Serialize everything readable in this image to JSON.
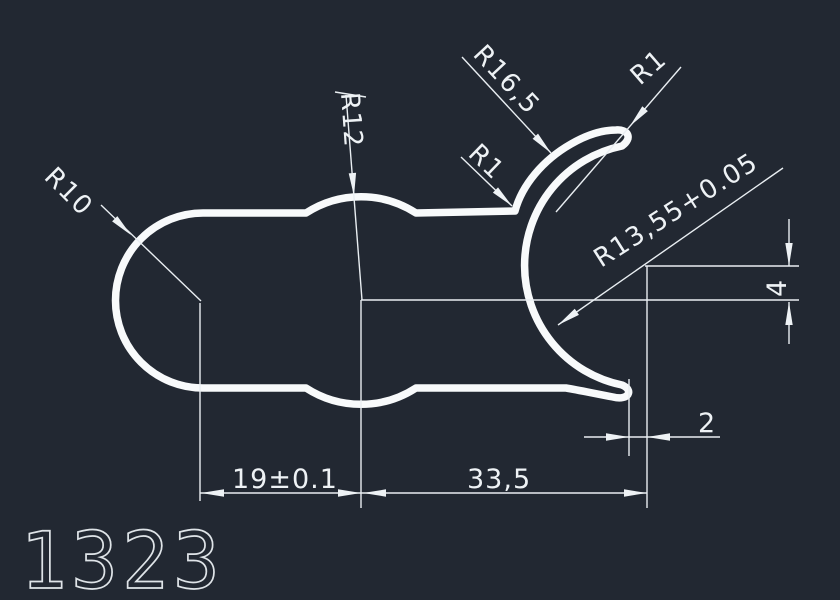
{
  "canvas": {
    "background": "#222832",
    "profile_line_color": "#f8fafb",
    "dimension_line_color": "#e9eef2",
    "text_color": "#eef2f5"
  },
  "labels": {
    "r10": "R10",
    "r12": "R12",
    "r16_5": "R16,5",
    "r1_corner": "R1",
    "r1_tip": "R1",
    "r13_55": "R13,55+0.05"
  },
  "dims": {
    "d19": "19±0.1",
    "d33_5": "33,5",
    "d2": "2",
    "d4": "4"
  },
  "part_number": "1323"
}
